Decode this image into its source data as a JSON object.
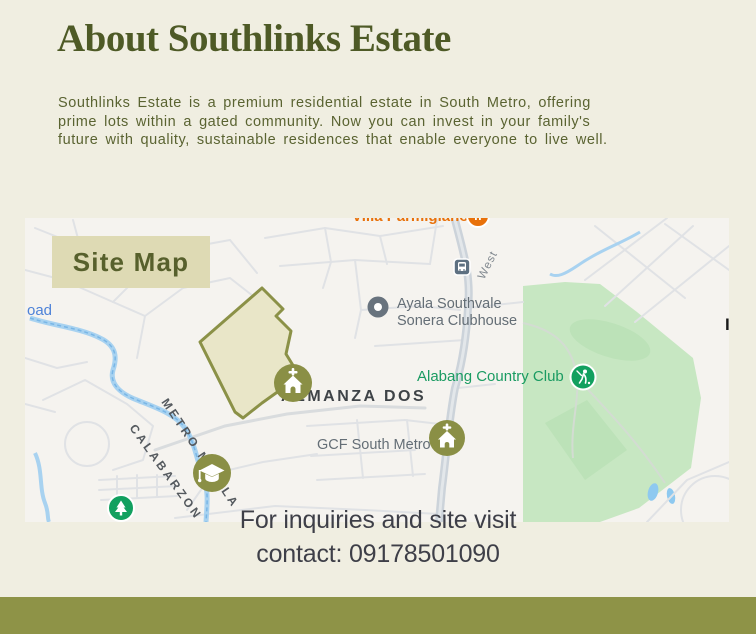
{
  "header": {
    "title": "About Southlinks Estate",
    "description": "Southlinks Estate is a premium residential estate in South Metro, offering\nprime lots within a gated community. Now you can invest in your family's\nfuture with quality, sustainable residences that enable everyone to live well."
  },
  "map": {
    "badge_label": "Site Map",
    "labels": {
      "villa_parmigiano": "Villa Parmigiano",
      "west_road": "West",
      "road_fragment": "oad",
      "edge_fragment": "I",
      "ayala_line1": "Ayala Southvale",
      "ayala_line2": "Sonera Clubhouse",
      "alabang_country_club": "Alabang Country Club",
      "almanza_dos": "ALMANZA DOS",
      "gcf_south_metro": "GCF South Metro",
      "metro_manila": "METRO MANILA",
      "calabarzon": "CALABARZON"
    },
    "markers": [
      {
        "name": "restaurant-marker",
        "poi": "Villa Parmigiano"
      },
      {
        "name": "transit-station-marker",
        "poi": "bus station"
      },
      {
        "name": "place-pin-marker",
        "poi": "Ayala Southvale Sonera Clubhouse"
      },
      {
        "name": "golf-marker",
        "poi": "Alabang Country Club"
      },
      {
        "name": "church-marker",
        "poi": "estate church"
      },
      {
        "name": "church-marker",
        "poi": "GCF South Metro"
      },
      {
        "name": "school-marker",
        "poi": "school"
      },
      {
        "name": "park-tree-marker",
        "poi": "park"
      }
    ]
  },
  "contact": {
    "note": "For inquiries and site visit\ncontact: 09178501090"
  },
  "colors": {
    "page_background": "#f0eee1",
    "heading_green": "#4e5a26",
    "body_green": "#5a6331",
    "badge_background": "#dedab4",
    "badge_text": "#57602c",
    "footer_olive": "#8e9347",
    "estate_marker_olive": "#8a8f45",
    "estate_polygon_fill": "#e9e6c8",
    "estate_polygon_stroke": "#8b9147",
    "map_park_green": "#c7e7c2",
    "map_water_blue": "#a8d2f0",
    "poi_green": "#12a05f",
    "poi_orange": "#e8710a",
    "contact_text": "#3e3f48"
  }
}
